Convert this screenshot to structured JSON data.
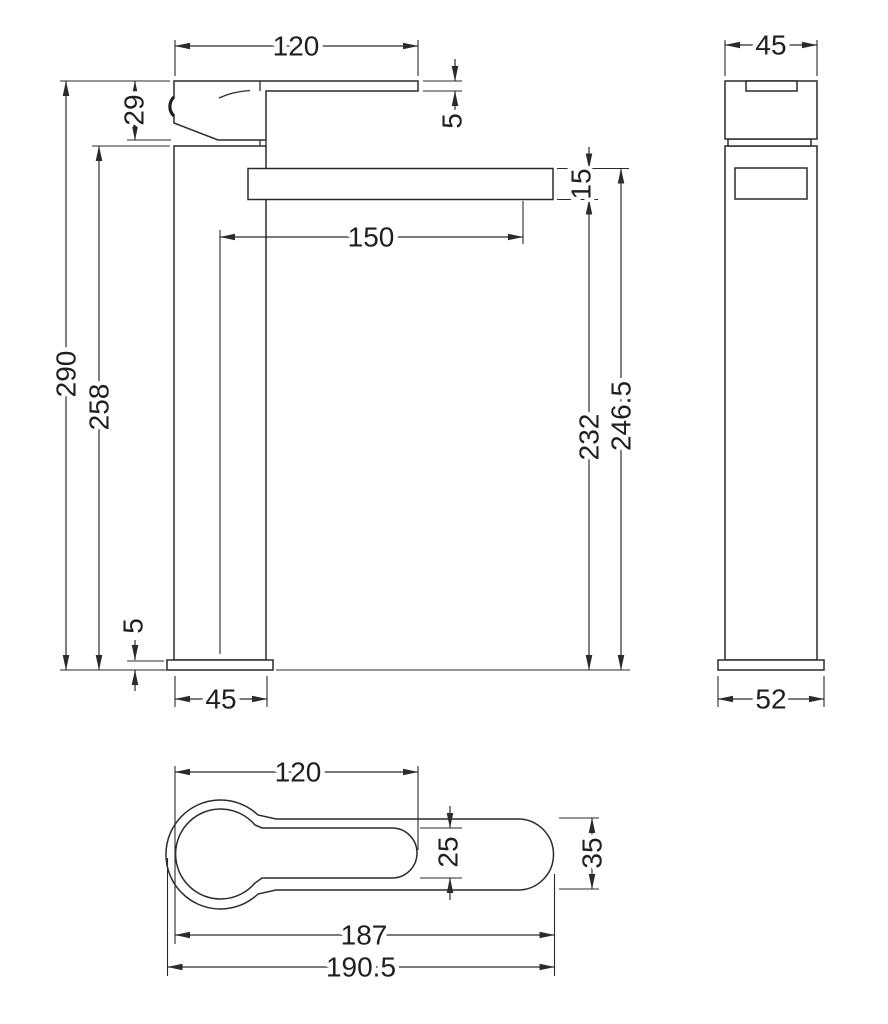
{
  "drawing": {
    "unit_values": {
      "front": {
        "lever_length": "120",
        "handle_height": "29",
        "lever_thickness": "5",
        "spout_thickness": "15",
        "spout_projection": "150",
        "overall_height": "290",
        "body_height": "258",
        "height_to_spout_bottom": "232",
        "height_to_spout_top": "246.5",
        "base_thickness": "5",
        "body_width": "45"
      },
      "side": {
        "head_width": "45",
        "base_width": "52"
      },
      "plan": {
        "lever_length": "120",
        "lever_width": "25",
        "spout_width": "35",
        "body_length": "187",
        "overall_length": "190.5"
      }
    }
  }
}
